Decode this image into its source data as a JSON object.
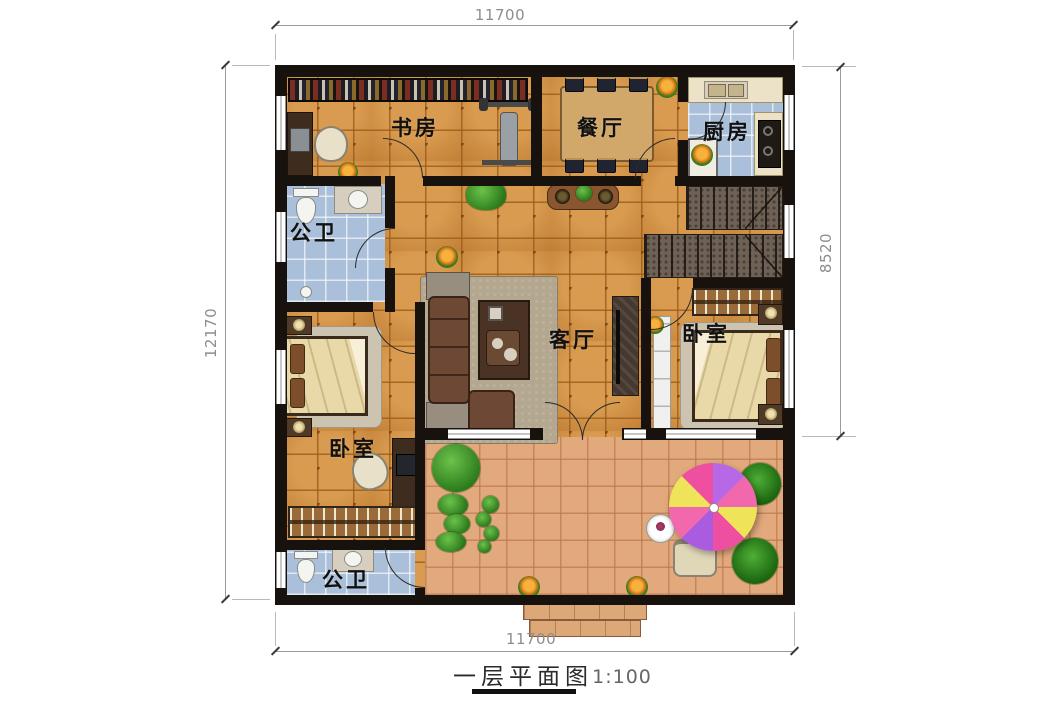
{
  "title": {
    "text": "一层平面图",
    "scale": "1:100"
  },
  "dimensions": {
    "top": "11700",
    "bottom": "11700",
    "left": "12170",
    "right": "8520"
  },
  "rooms": [
    {
      "id": "study",
      "label": "书房"
    },
    {
      "id": "dining",
      "label": "餐厅"
    },
    {
      "id": "kitchen",
      "label": "厨房"
    },
    {
      "id": "bath-upper",
      "label": "公卫"
    },
    {
      "id": "living",
      "label": "客厅"
    },
    {
      "id": "bedroom-right",
      "label": "卧室"
    },
    {
      "id": "bedroom-left",
      "label": "卧室"
    },
    {
      "id": "bath-lower",
      "label": "公卫"
    }
  ],
  "colors": {
    "wall": "#17120d",
    "floor_tile": "#cb8a3e",
    "patio_tile": "#e2a97c",
    "bath_tile": "#aabfd9",
    "stair": "#6e6156",
    "wood": "#8a5a32",
    "umbrella": [
      "#b668e6",
      "#f268ac",
      "#efe35a",
      "#ee4fa0"
    ]
  }
}
